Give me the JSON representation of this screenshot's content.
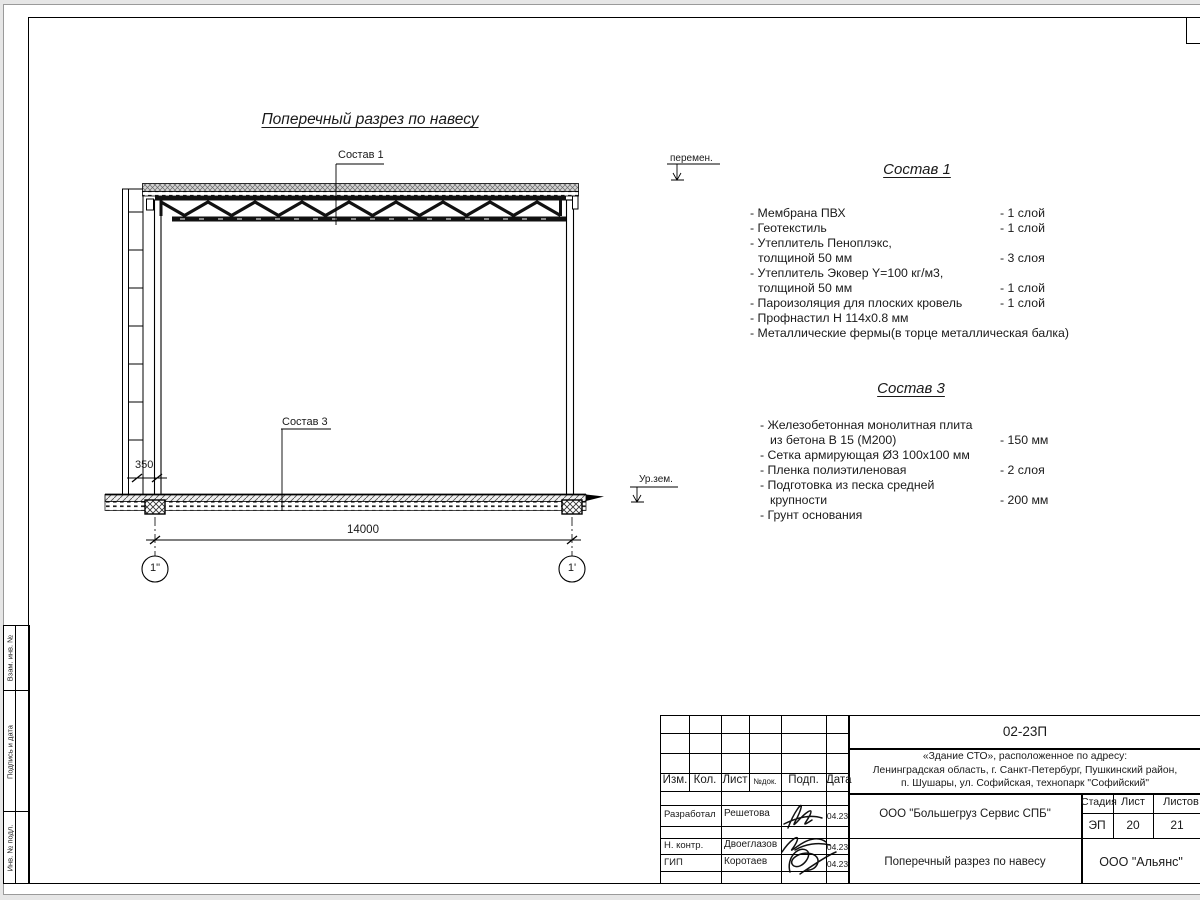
{
  "colors": {
    "line": "#000000",
    "paper": "#ffffff",
    "hatch_fill": "#d8d8d8"
  },
  "drawing": {
    "title": "Поперечный разрез по навесу",
    "callout_roof": "Состав 1",
    "callout_floor": "Состав 3",
    "level_variable": "перемен.",
    "level_ground": "Ур.зем.",
    "dim_span": "14000",
    "dim_offset": "350",
    "axis_left": "1\"",
    "axis_right": "1'"
  },
  "spec1": {
    "heading": "Состав 1",
    "lines": [
      {
        "t": "- Мембрана ПВХ",
        "v": "- 1 слой"
      },
      {
        "t": "- Геотекстиль",
        "v": "- 1 слой"
      },
      {
        "t": "- Утеплитель Пеноплэкс,",
        "v": ""
      },
      {
        "t": "толщиной 50 мм",
        "v": "- 3 слоя"
      },
      {
        "t": "- Утеплитель Эковер Y=100 кг/м3,",
        "v": ""
      },
      {
        "t": "толщиной 50 мм",
        "v": "- 1 слой"
      },
      {
        "t": "- Пароизоляция для плоских кровель",
        "v": "- 1 слой"
      },
      {
        "t": "- Профнастил Н 114х0.8 мм",
        "v": ""
      },
      {
        "t": "- Металлические фермы(в торце металлическая балка)",
        "v": ""
      }
    ]
  },
  "spec3": {
    "heading": "Состав 3",
    "lines": [
      {
        "t": "- Железобетонная  монолитная плита",
        "v": ""
      },
      {
        "t": "из бетона В 15 (М200)",
        "v": "- 150 мм"
      },
      {
        "t": "- Сетка армирующая Ø3 100х100 мм",
        "v": ""
      },
      {
        "t": "- Пленка полиэтиленовая",
        "v": "-  2 слоя"
      },
      {
        "t": "- Подготовка из песка средней",
        "v": ""
      },
      {
        "t": "крупности",
        "v": "- 200 мм"
      },
      {
        "t": "- Грунт основания",
        "v": ""
      }
    ]
  },
  "titleblock": {
    "doc_number": "02-23П",
    "project_address": "«Здание СТО», расположенное по адресу:\nЛенинградская область, г. Санкт-Петербург, Пушкинский район,\nп. Шушары, ул. Софийская, технопарк \"Софийский\"",
    "table_headers": [
      "Изм.",
      "Кол.",
      "Лист",
      "№док.",
      "Подп.",
      "Дата"
    ],
    "signing_rows": [
      {
        "role": "Разработал",
        "name": "Решетова",
        "date": "04.23"
      },
      {
        "role": "Н. контр.",
        "name": "Двоеглазов",
        "date": "04.23"
      },
      {
        "role": "ГИП",
        "name": "Коротаев",
        "date": "04.23"
      }
    ],
    "contractor": "ООО \"Большегруз Сервис СПБ\"",
    "stage_label": "Стадия",
    "sheet_label": "Лист",
    "sheets_label": "Листов",
    "stage": "ЭП",
    "sheet_no": "20",
    "sheets_total": "21",
    "drawing_name": "Поперечный разрез по навесу",
    "org": "ООО \"Альянс\""
  },
  "side_strip": {
    "cells": [
      "Взам. инв. №",
      "Подпись и дата",
      "Инв. № подл."
    ]
  }
}
